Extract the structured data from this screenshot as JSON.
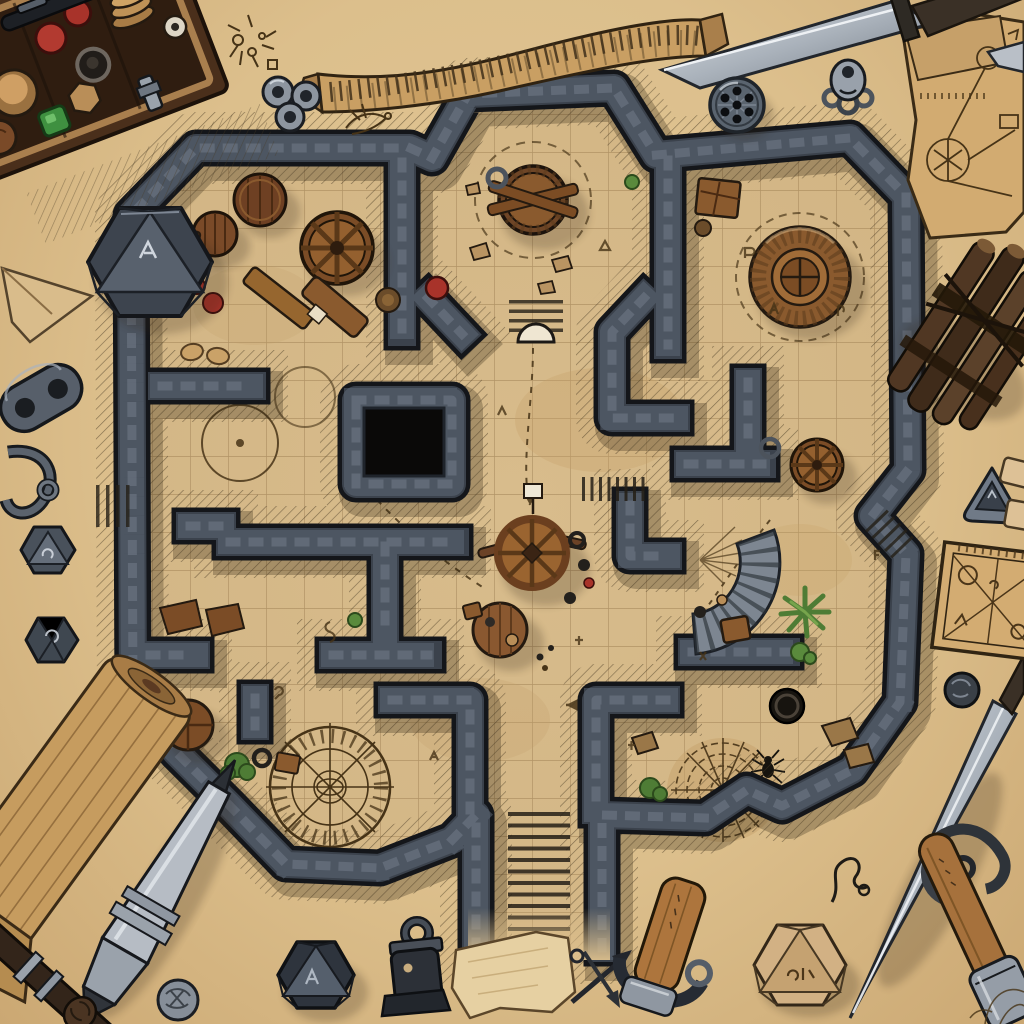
{
  "scene": {
    "type": "fantasy-dungeon-battle-map",
    "style": "hand-drawn ink and wash illustration on parchment, top-down view",
    "description": "A top-down hand-inked dungeon battle map drawn on aged parchment, surrounded by tabletop gaming props: dice, a dice box, daggers, pens, scrolls and trinkets.",
    "visible_text": "none (only tally marks and rune-like scribbles, no readable words)"
  },
  "colors": {
    "parchment": "#e2c796",
    "parchmentEdge": "#cba873",
    "floor": "#d8bc8c",
    "gridLine": "#a4865a",
    "wallDark": "#14161a",
    "wallMid": "#3b424c",
    "wallLight": "#5f6977",
    "ink": "#463317",
    "woodDark": "#5b3a22",
    "woodMid": "#8a5a2e",
    "woodLight": "#b07a42",
    "steelDark": "#3a3f46",
    "steelMid": "#7e8691",
    "steelLight": "#c7ccd2",
    "red": "#a8332a",
    "green": "#4e7c35",
    "teal": "#3f7d74",
    "pitBlack": "#0a0908"
  },
  "map": {
    "grid_size_px": 38,
    "label": "stone dungeon with grid floor",
    "rooms": [
      {
        "label": "northwest storage room",
        "contents": "two wooden barrels, wagon wheel, crates, bench, red tokens, teal scroll coils"
      },
      {
        "label": "north octagonal chamber",
        "contents": "central round well with crossed beams, scattered rocks, dashed ritual ring"
      },
      {
        "label": "northeast round-dais chamber",
        "contents": "large circular wooden platform, crate shelf, rune scribbles"
      },
      {
        "label": "central hall",
        "contents": "spoked wheel table with banner, round plank table, scattered tokens, black pit alcove"
      },
      {
        "label": "east chamber",
        "contents": "wagon wheel, curved stone stair arc, palm plant, crates"
      },
      {
        "label": "southwest ritual room",
        "contents": "large inked summoning/compass circle, round table, shrub"
      },
      {
        "label": "southeast web room",
        "contents": "spider web floor drawing, spider, dark well, rocks, plants"
      }
    ],
    "entrances": [
      {
        "label": "south main staircase",
        "detail": "wide stair flight exiting bottom center, fading into parchment"
      },
      {
        "label": "north arched door with steps",
        "detail": "small stair and white arch between octagon and central hall"
      },
      {
        "label": "west side steps",
        "detail": "small hatched stair stub outside the west wall"
      },
      {
        "label": "east notch steps",
        "detail": "small diagonal steps in the east wall recess"
      }
    ],
    "features": [
      {
        "label": "octagon well"
      },
      {
        "label": "round wooden dais"
      },
      {
        "label": "central wheel table"
      },
      {
        "label": "black pit"
      },
      {
        "label": "ritual circle"
      },
      {
        "label": "spider web"
      },
      {
        "label": "curved stair arc"
      },
      {
        "label": "dashed travel paths with arrows"
      },
      {
        "label": "faint inked circles"
      },
      {
        "label": "rune scribbles"
      }
    ]
  },
  "props": [
    {
      "label": "wooden dice box with round tokens and dice"
    },
    {
      "label": "large slate twenty-sided die"
    },
    {
      "label": "folded paper dart"
    },
    {
      "label": "metal chain clasp"
    },
    {
      "label": "metal hook trinket"
    },
    {
      "label": "small slate die"
    },
    {
      "label": "small slate die with glyph"
    },
    {
      "label": "rolled parchment scroll"
    },
    {
      "label": "steel stylus pen"
    },
    {
      "label": "carved dark wand"
    },
    {
      "label": "engraved silver coin"
    },
    {
      "label": "dark twenty-sided die"
    },
    {
      "label": "ink bottle charm"
    },
    {
      "label": "torn parchment scrap"
    },
    {
      "label": "crossed arrow trinkets"
    },
    {
      "label": "corked wooden tool with leather strap"
    },
    {
      "label": "tan twenty-sided die with runes"
    },
    {
      "label": "longsword with curved guard"
    },
    {
      "label": "wooden pen with steel cap"
    },
    {
      "label": "bent wire squiggle trinket"
    },
    {
      "label": "dark engraved coin"
    },
    {
      "label": "triangular metal token"
    },
    {
      "label": "outlined blank tokens"
    },
    {
      "label": "square sketched diagram sheet"
    },
    {
      "label": "bundle of dark sticks tied with cord"
    },
    {
      "label": "torn blueprint sketch sheet"
    },
    {
      "label": "tan ribbon banner with tally marks"
    },
    {
      "label": "inked bug doodle"
    },
    {
      "label": "cluster of silver ring charms"
    },
    {
      "label": "inked bird doodle"
    },
    {
      "label": "steel dagger"
    },
    {
      "label": "steel pen nib at right edge"
    },
    {
      "label": "silver skull charm"
    },
    {
      "label": "slate button token with black pips"
    },
    {
      "label": "faint anatomical doodle"
    }
  ]
}
